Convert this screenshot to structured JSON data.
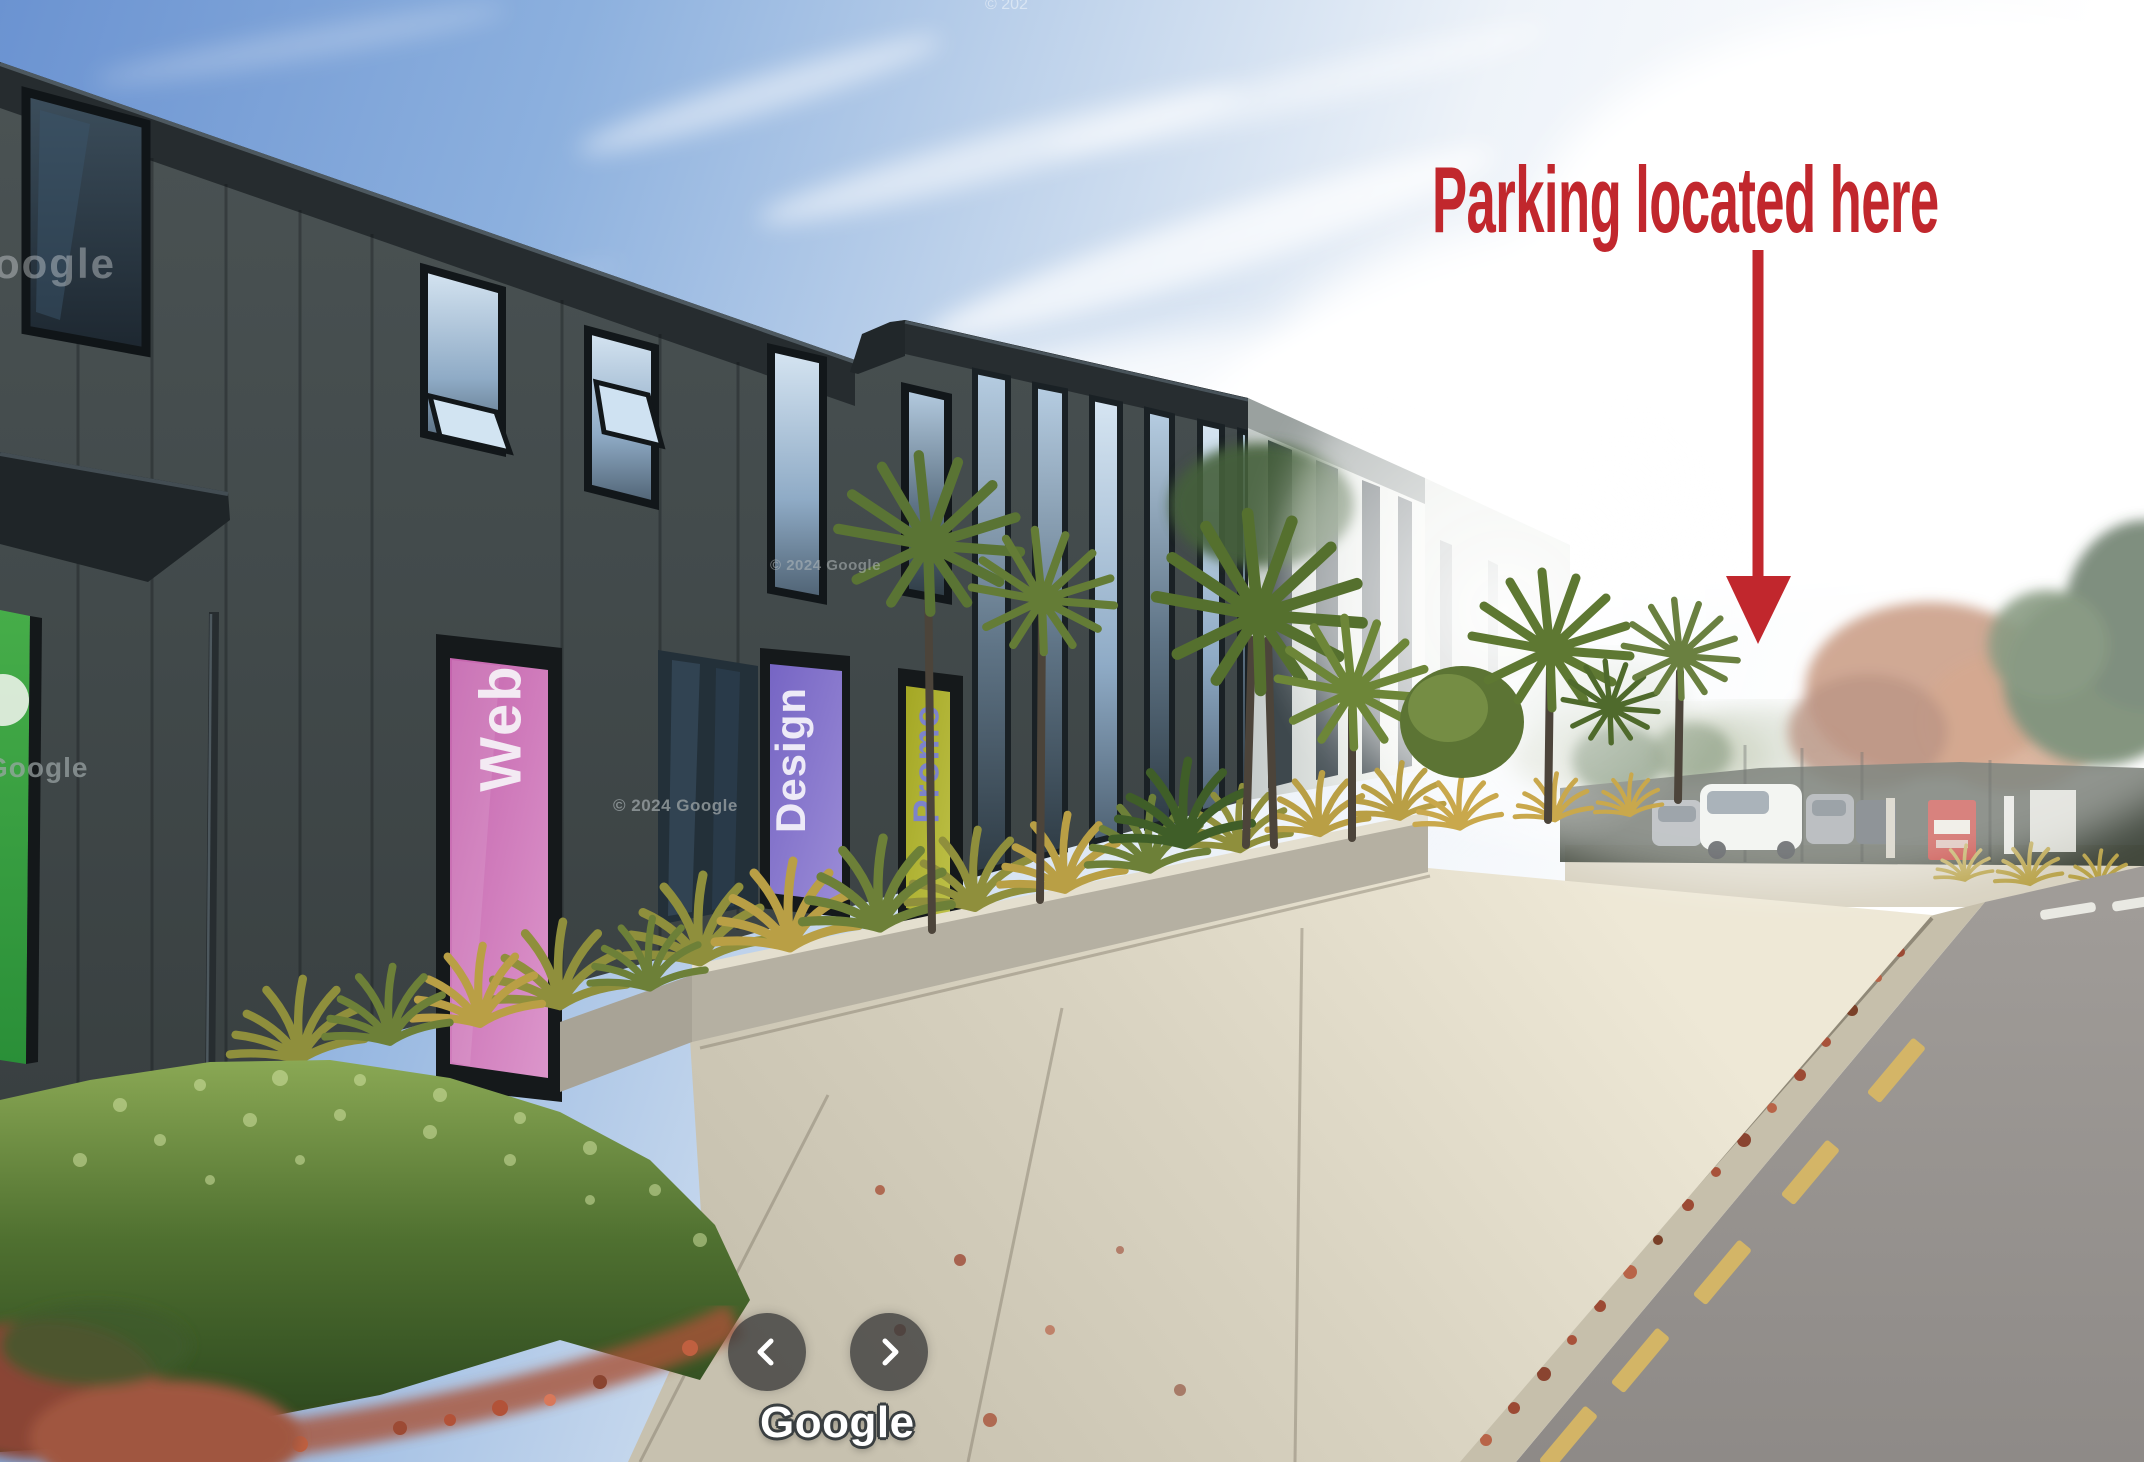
{
  "annotation": {
    "text": "Parking located here",
    "color": "#c1272d",
    "arrow_icon": "arrow-down"
  },
  "building": {
    "banners": [
      {
        "label": "Web",
        "panel_color": "#c96cb4",
        "text_color": "#f3eaf3"
      },
      {
        "label": "Design",
        "panel_color": "#8170cb",
        "text_color": "#edeaf7"
      },
      {
        "label": "Promo",
        "panel_color": "#aaad2c",
        "text_color": "#7d83cb"
      }
    ]
  },
  "street_view": {
    "watermarks": {
      "top_center": "© 202",
      "top_left_partial": "oogle",
      "left_partial": "Google",
      "facade_upper": "© 2024 Google",
      "facade_lower": "© 2024 Google"
    },
    "ui": {
      "logo_text": "Google",
      "prev_icon": "chevron-left",
      "next_icon": "chevron-right",
      "button_color": "rgba(58,58,58,0.78)"
    }
  }
}
